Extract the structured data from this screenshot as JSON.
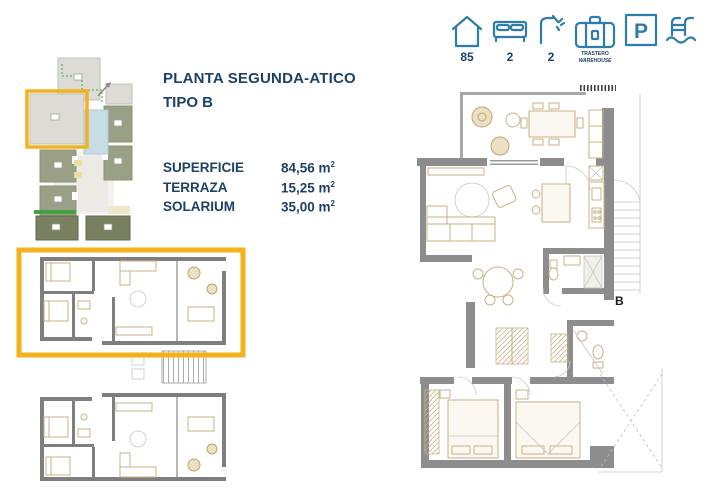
{
  "colors": {
    "navy": "#1d4066",
    "blue": "#2e7cab",
    "yellow": "#f3b21b",
    "wall": "#8d8d8d",
    "furn": "#c9b185",
    "olive": "#9aa086",
    "olive-dark": "#78805f",
    "green": "#43a047",
    "pool": "#c7dde6"
  },
  "header": {
    "title_line1": "PLANTA SEGUNDA-ATICO",
    "title_line2": "TIPO B"
  },
  "specs": {
    "unit": "m",
    "unit_sup": "2",
    "rows": [
      {
        "label": "SUPERFICIE",
        "value": "84,56"
      },
      {
        "label": "TERRAZA",
        "value": "15,25"
      },
      {
        "label": "SOLARIUM",
        "value": "35,00"
      }
    ]
  },
  "amenities": {
    "items": [
      {
        "icon": "house-icon",
        "value": "85"
      },
      {
        "icon": "bed-icon",
        "value": "2"
      },
      {
        "icon": "shower-icon",
        "value": "2"
      },
      {
        "icon": "storage-icon",
        "label_line1": "TRASTERO",
        "label_line2": "WAREHOUSE"
      },
      {
        "icon": "parking-icon",
        "glyph": "P"
      },
      {
        "icon": "pool-ladder-icon"
      }
    ]
  },
  "detail_plan": {
    "unit_label": "B"
  }
}
